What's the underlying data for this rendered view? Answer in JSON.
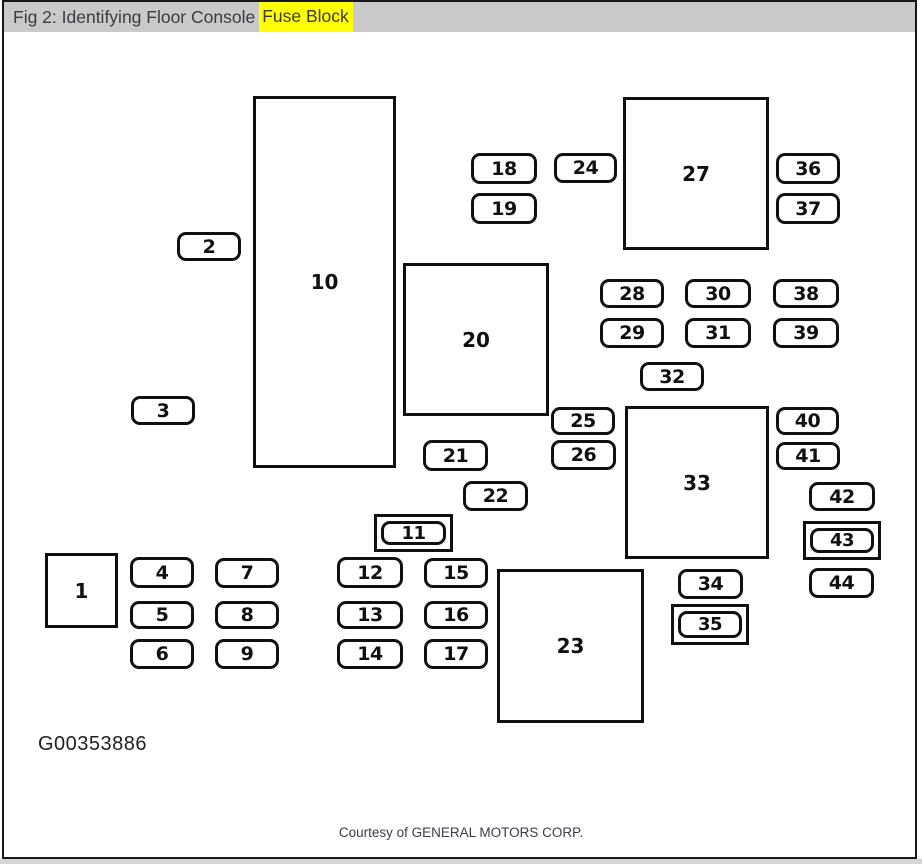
{
  "window": {
    "title_prefix": "Fig 2: Identifying Floor Console",
    "title_highlight": "Fuse Block",
    "highlight_color": "#ffff00",
    "titlebar_color": "#c9c9c9"
  },
  "figure": {
    "id_code": "G00353886",
    "credit": "Courtesy of GENERAL MOTORS CORP."
  },
  "diagram": {
    "description": "Floor console fuse block layout with numbered fuses and relay blocks",
    "components": [
      {
        "id": "c1",
        "label": "1",
        "shape": "box"
      },
      {
        "id": "c2",
        "label": "2",
        "shape": "fuse"
      },
      {
        "id": "c3",
        "label": "3",
        "shape": "fuse"
      },
      {
        "id": "c4",
        "label": "4",
        "shape": "fuse"
      },
      {
        "id": "c5",
        "label": "5",
        "shape": "fuse"
      },
      {
        "id": "c6",
        "label": "6",
        "shape": "fuse"
      },
      {
        "id": "c7",
        "label": "7",
        "shape": "fuse"
      },
      {
        "id": "c8",
        "label": "8",
        "shape": "fuse"
      },
      {
        "id": "c9",
        "label": "9",
        "shape": "fuse"
      },
      {
        "id": "c10",
        "label": "10",
        "shape": "box"
      },
      {
        "id": "c11",
        "label": "11",
        "shape": "fuse-double"
      },
      {
        "id": "c12",
        "label": "12",
        "shape": "fuse"
      },
      {
        "id": "c13",
        "label": "13",
        "shape": "fuse"
      },
      {
        "id": "c14",
        "label": "14",
        "shape": "fuse"
      },
      {
        "id": "c15",
        "label": "15",
        "shape": "fuse"
      },
      {
        "id": "c16",
        "label": "16",
        "shape": "fuse"
      },
      {
        "id": "c17",
        "label": "17",
        "shape": "fuse"
      },
      {
        "id": "c18",
        "label": "18",
        "shape": "fuse"
      },
      {
        "id": "c19",
        "label": "19",
        "shape": "fuse"
      },
      {
        "id": "c20",
        "label": "20",
        "shape": "box"
      },
      {
        "id": "c21",
        "label": "21",
        "shape": "fuse"
      },
      {
        "id": "c22",
        "label": "22",
        "shape": "fuse"
      },
      {
        "id": "c23",
        "label": "23",
        "shape": "box"
      },
      {
        "id": "c24",
        "label": "24",
        "shape": "fuse"
      },
      {
        "id": "c25",
        "label": "25",
        "shape": "fuse"
      },
      {
        "id": "c26",
        "label": "26",
        "shape": "fuse"
      },
      {
        "id": "c27",
        "label": "27",
        "shape": "box"
      },
      {
        "id": "c28",
        "label": "28",
        "shape": "fuse"
      },
      {
        "id": "c29",
        "label": "29",
        "shape": "fuse"
      },
      {
        "id": "c30",
        "label": "30",
        "shape": "fuse"
      },
      {
        "id": "c31",
        "label": "31",
        "shape": "fuse"
      },
      {
        "id": "c32",
        "label": "32",
        "shape": "fuse"
      },
      {
        "id": "c33",
        "label": "33",
        "shape": "box"
      },
      {
        "id": "c34",
        "label": "34",
        "shape": "fuse"
      },
      {
        "id": "c35",
        "label": "35",
        "shape": "fuse-double"
      },
      {
        "id": "c36",
        "label": "36",
        "shape": "fuse"
      },
      {
        "id": "c37",
        "label": "37",
        "shape": "fuse"
      },
      {
        "id": "c38",
        "label": "38",
        "shape": "fuse"
      },
      {
        "id": "c39",
        "label": "39",
        "shape": "fuse"
      },
      {
        "id": "c40",
        "label": "40",
        "shape": "fuse"
      },
      {
        "id": "c41",
        "label": "41",
        "shape": "fuse"
      },
      {
        "id": "c42",
        "label": "42",
        "shape": "fuse"
      },
      {
        "id": "c43",
        "label": "43",
        "shape": "fuse-double"
      },
      {
        "id": "c44",
        "label": "44",
        "shape": "fuse"
      }
    ]
  }
}
